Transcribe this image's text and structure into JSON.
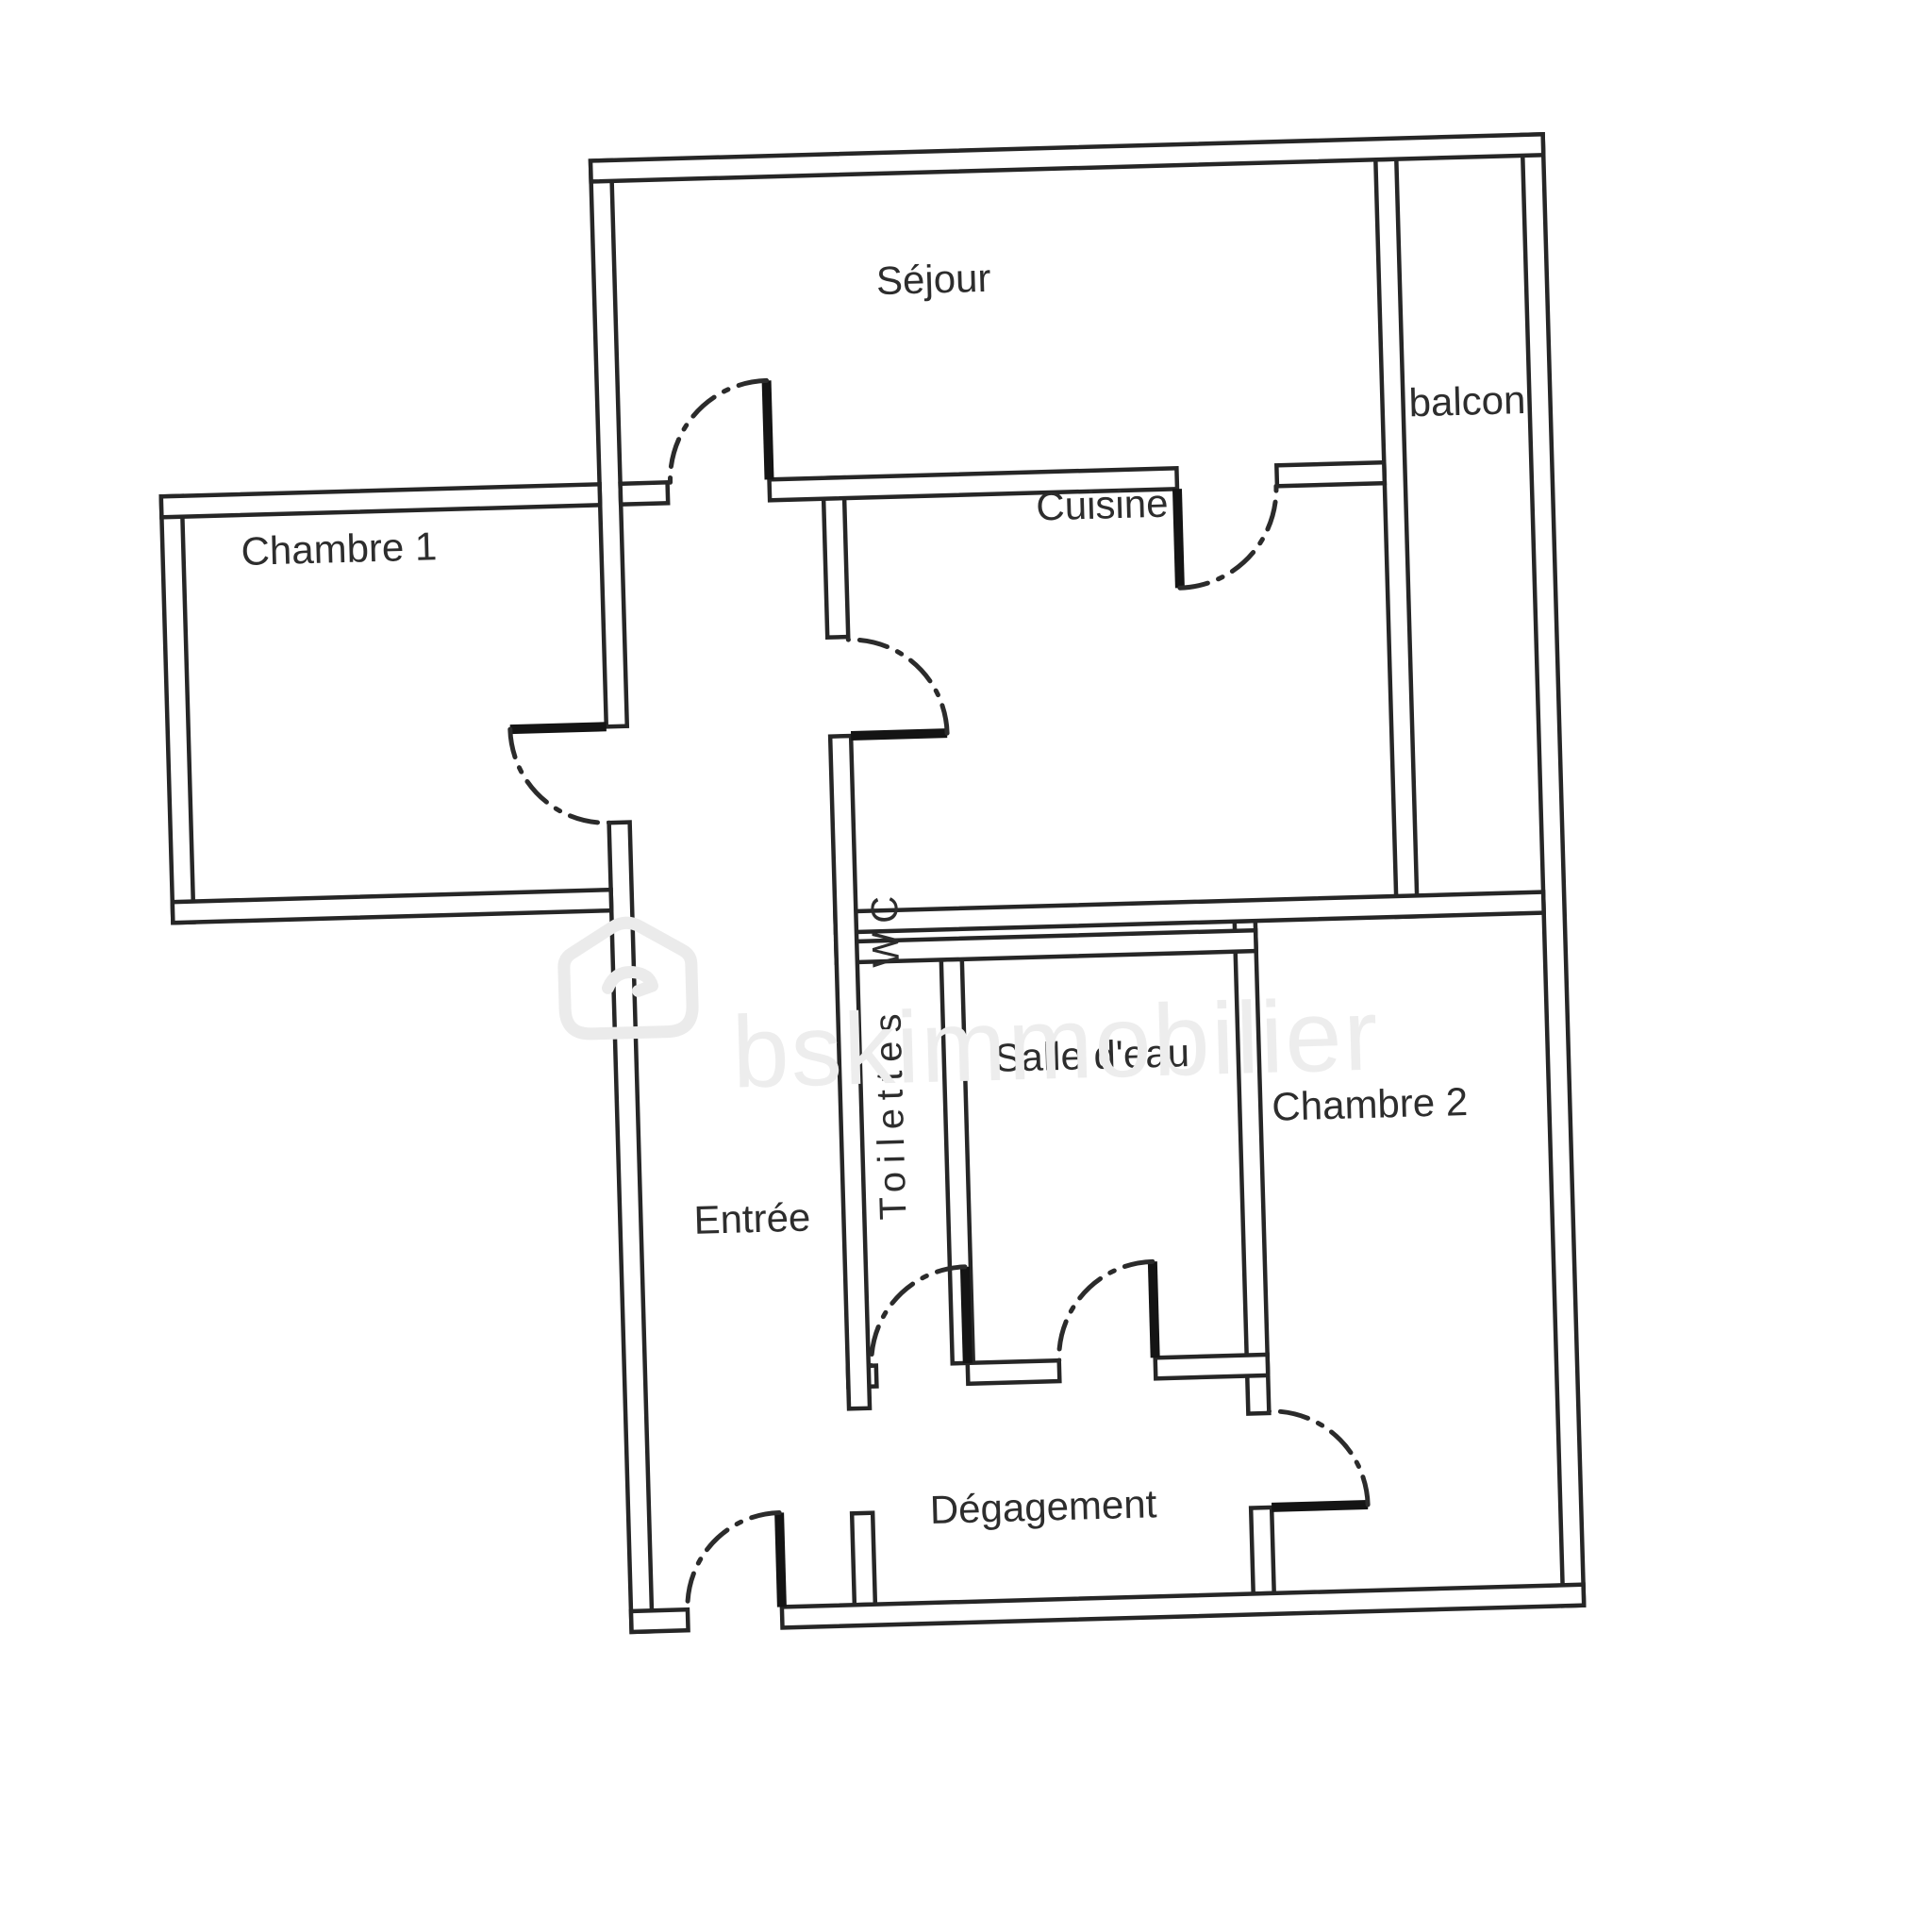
{
  "watermark": {
    "brand": "bskimmobilier",
    "logo": "bsk-house-logo",
    "color": "#ededed"
  },
  "plan": {
    "background": "#ffffff",
    "wall_color": "#262626",
    "label_color": "#2d2d2d",
    "rooms": [
      {
        "id": "sejour",
        "label": "Séjour"
      },
      {
        "id": "balcon",
        "label": "balcon"
      },
      {
        "id": "chambre-1",
        "label": "Chambre 1"
      },
      {
        "id": "cuisine",
        "label": "Cuisine"
      },
      {
        "id": "entree",
        "label": "Entrée"
      },
      {
        "id": "toilettes-wc",
        "label": "Toilettes  WC"
      },
      {
        "id": "salle-deau",
        "label": "Salle d'eau"
      },
      {
        "id": "chambre-2",
        "label": "Chambre 2"
      },
      {
        "id": "degagement",
        "label": "Dégagement"
      }
    ]
  }
}
